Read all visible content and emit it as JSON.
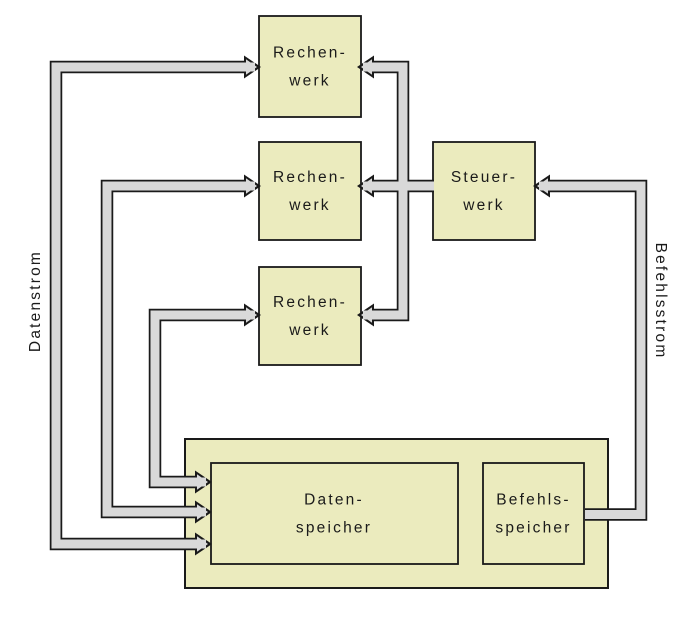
{
  "blocks": {
    "rechenwerk_1": {
      "line1": "Rechen-",
      "line2": "werk"
    },
    "rechenwerk_2": {
      "line1": "Rechen-",
      "line2": "werk"
    },
    "rechenwerk_3": {
      "line1": "Rechen-",
      "line2": "werk"
    },
    "steuerwerk": {
      "line1": "Steuer-",
      "line2": "werk"
    },
    "datenspeicher": {
      "line1": "Daten-",
      "line2": "speicher"
    },
    "befehlsspeicher": {
      "line1": "Befehls-",
      "line2": "speicher"
    }
  },
  "stream_labels": {
    "left": "Datenstrom",
    "right": "Befehlsstrom"
  },
  "colors": {
    "background": "#ffffff",
    "block_fill": "#ebebbe",
    "block_border": "#1a1a1a",
    "pipe_fill": "#d9d9d9",
    "pipe_border": "#1a1a1a",
    "text": "#1a1a1a"
  }
}
